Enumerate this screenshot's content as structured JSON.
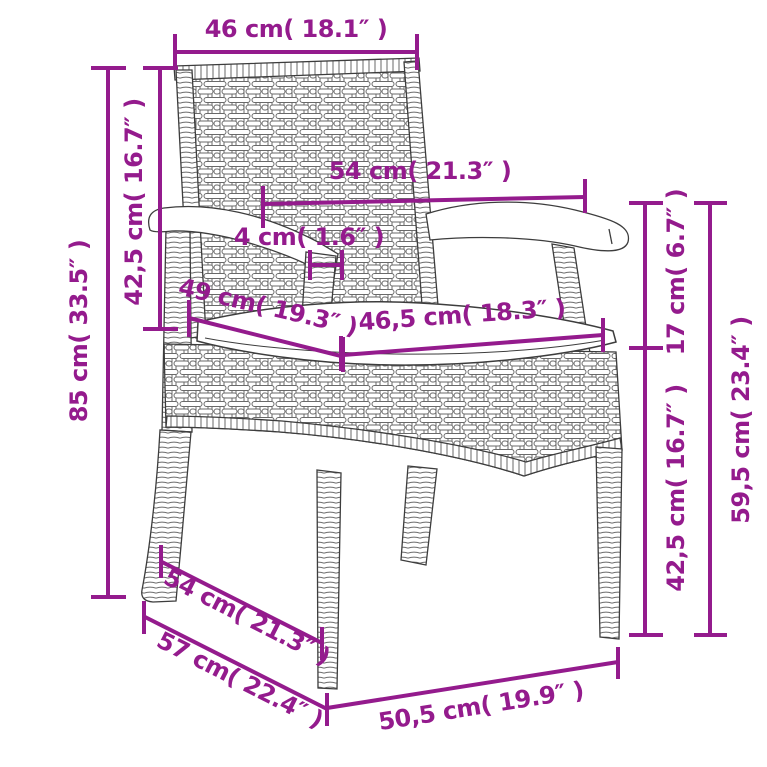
{
  "figure": {
    "title": "Poly rattan garden chair dimension diagram",
    "product": "wicker-armchair-with-cushion"
  },
  "colors": {
    "accent": "#941b8d",
    "line_art": "#3d3d3d",
    "background": "#ffffff"
  },
  "units": {
    "metric": "cm",
    "imperial": "in"
  },
  "dimensions": [
    {
      "id": "back-width",
      "label": "46 cm( 18.1″ )",
      "cm": 46,
      "inches": 18.1
    },
    {
      "id": "overall-height",
      "label": "85 cm( 33.5″ )",
      "cm": 85,
      "inches": 33.5
    },
    {
      "id": "backrest-height",
      "label": "42,5 cm( 16.7″ )",
      "cm": 42.5,
      "inches": 16.7
    },
    {
      "id": "armrest-span",
      "label": "54 cm( 21.3″ )",
      "cm": 54,
      "inches": 21.3
    },
    {
      "id": "armrest-post",
      "label": "4 cm( 1.6″ )",
      "cm": 4,
      "inches": 1.6
    },
    {
      "id": "seat-depth",
      "label": "49 cm( 19.3″ )",
      "cm": 49,
      "inches": 19.3
    },
    {
      "id": "seat-width",
      "label": "46,5 cm( 18.3″ )",
      "cm": 46.5,
      "inches": 18.3
    },
    {
      "id": "arm-above-seat",
      "label": "17 cm( 6.7″ )",
      "cm": 17,
      "inches": 6.7
    },
    {
      "id": "armrest-height",
      "label": "59,5 cm( 23.4″ )",
      "cm": 59.5,
      "inches": 23.4
    },
    {
      "id": "seat-height",
      "label": "42,5 cm( 16.7″ )",
      "cm": 42.5,
      "inches": 16.7
    },
    {
      "id": "depth-upper",
      "label": "54 cm( 21.3″ )",
      "cm": 54,
      "inches": 21.3
    },
    {
      "id": "overall-depth",
      "label": "57 cm( 22.4″ )",
      "cm": 57,
      "inches": 22.4
    },
    {
      "id": "front-width",
      "label": "50,5 cm( 19.9″ )",
      "cm": 50.5,
      "inches": 19.9
    }
  ]
}
